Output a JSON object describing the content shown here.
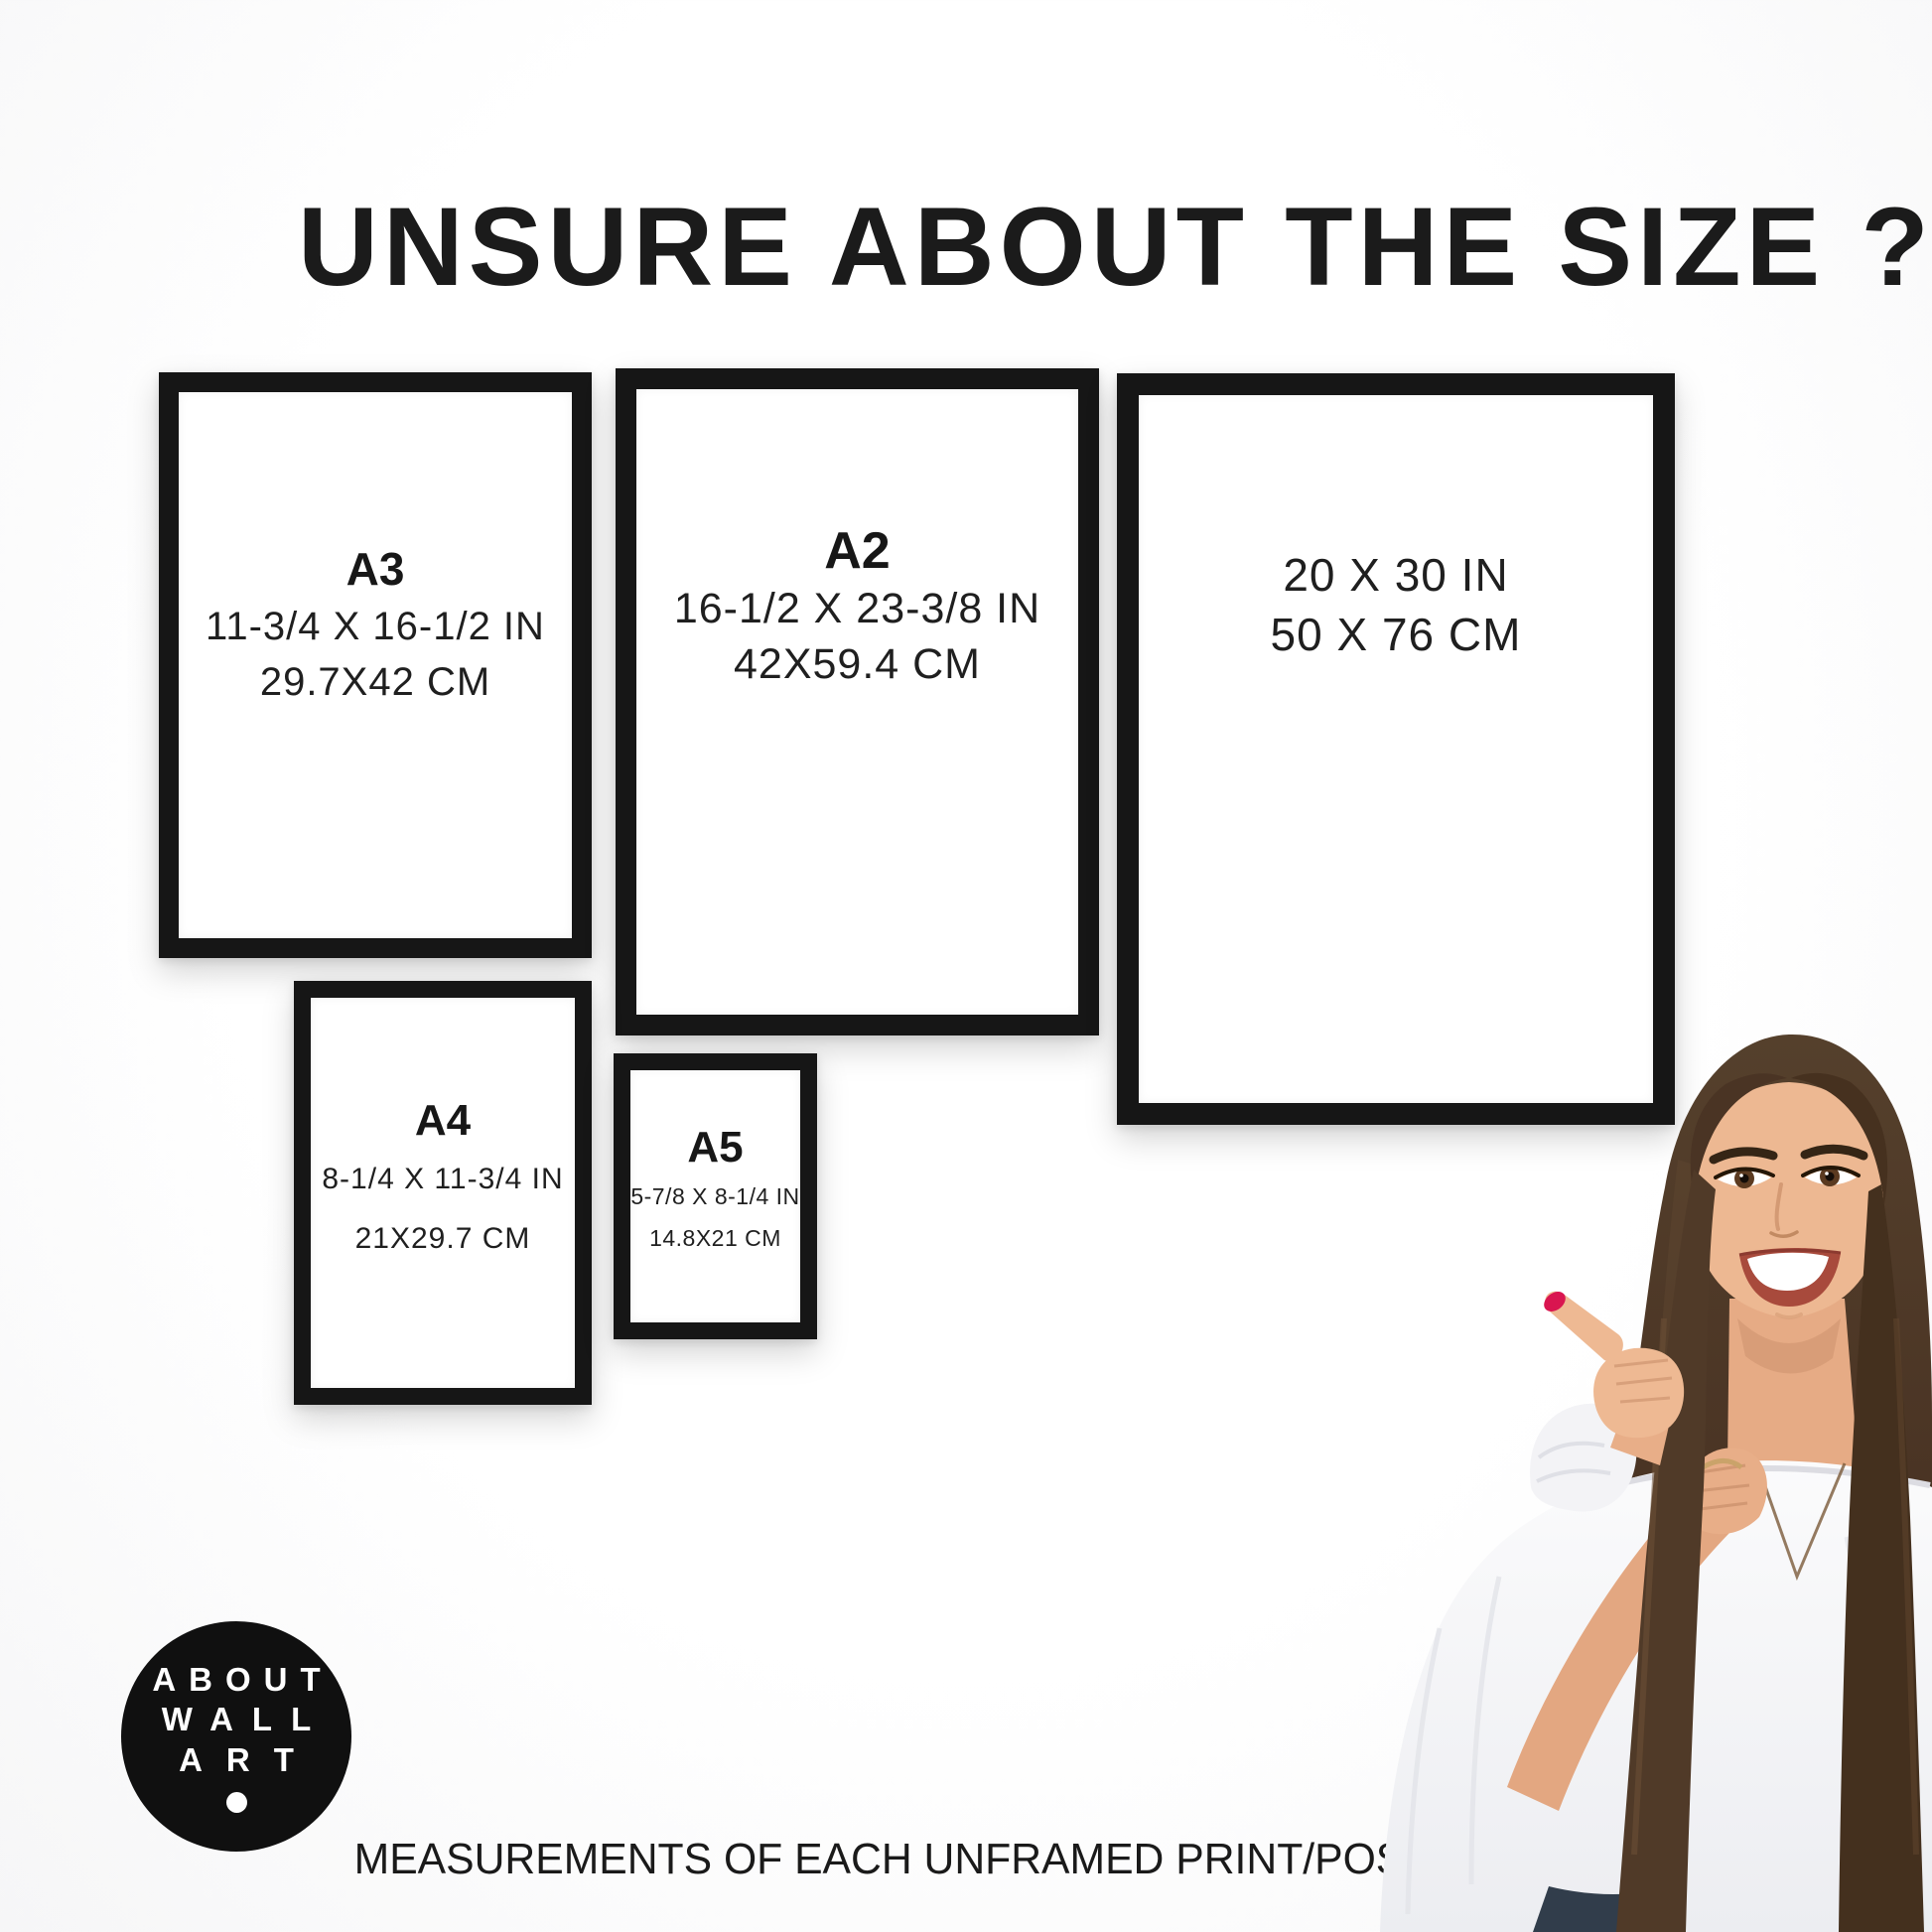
{
  "title": "UNSURE ABOUT THE SIZE ?",
  "footer": "MEASUREMENTS OF EACH UNFRAMED PRINT/POSTER",
  "logo": {
    "lines": [
      "ABOUT",
      "WALL",
      "ART"
    ]
  },
  "frames": [
    {
      "name": "A3",
      "label": "A3",
      "inches": "11-3/4 X 16-1/2 IN",
      "cm": "29.7X42 CM"
    },
    {
      "name": "A2",
      "label": "A2",
      "inches": "16-1/2 X 23-3/8 IN",
      "cm": "42X59.4 CM"
    },
    {
      "name": "20x30",
      "inches": "20 X 30 IN",
      "cm": "50 X 76 CM"
    },
    {
      "name": "A4",
      "label": "A4",
      "inches": "8-1/4 X 11-3/4 IN",
      "cm": "21X29.7 CM"
    },
    {
      "name": "A5",
      "label": "A5",
      "inches": "5-7/8 X 8-1/4 IN",
      "cm": "14.8X21 CM"
    }
  ],
  "colors": {
    "frame_border": "#161616",
    "text": "#1d1d1d",
    "logo_background": "#101010",
    "nail_accent": "#d91550",
    "hair": "#4a3424",
    "skin": "#eab38f",
    "blouse": "#f6f6f8"
  }
}
